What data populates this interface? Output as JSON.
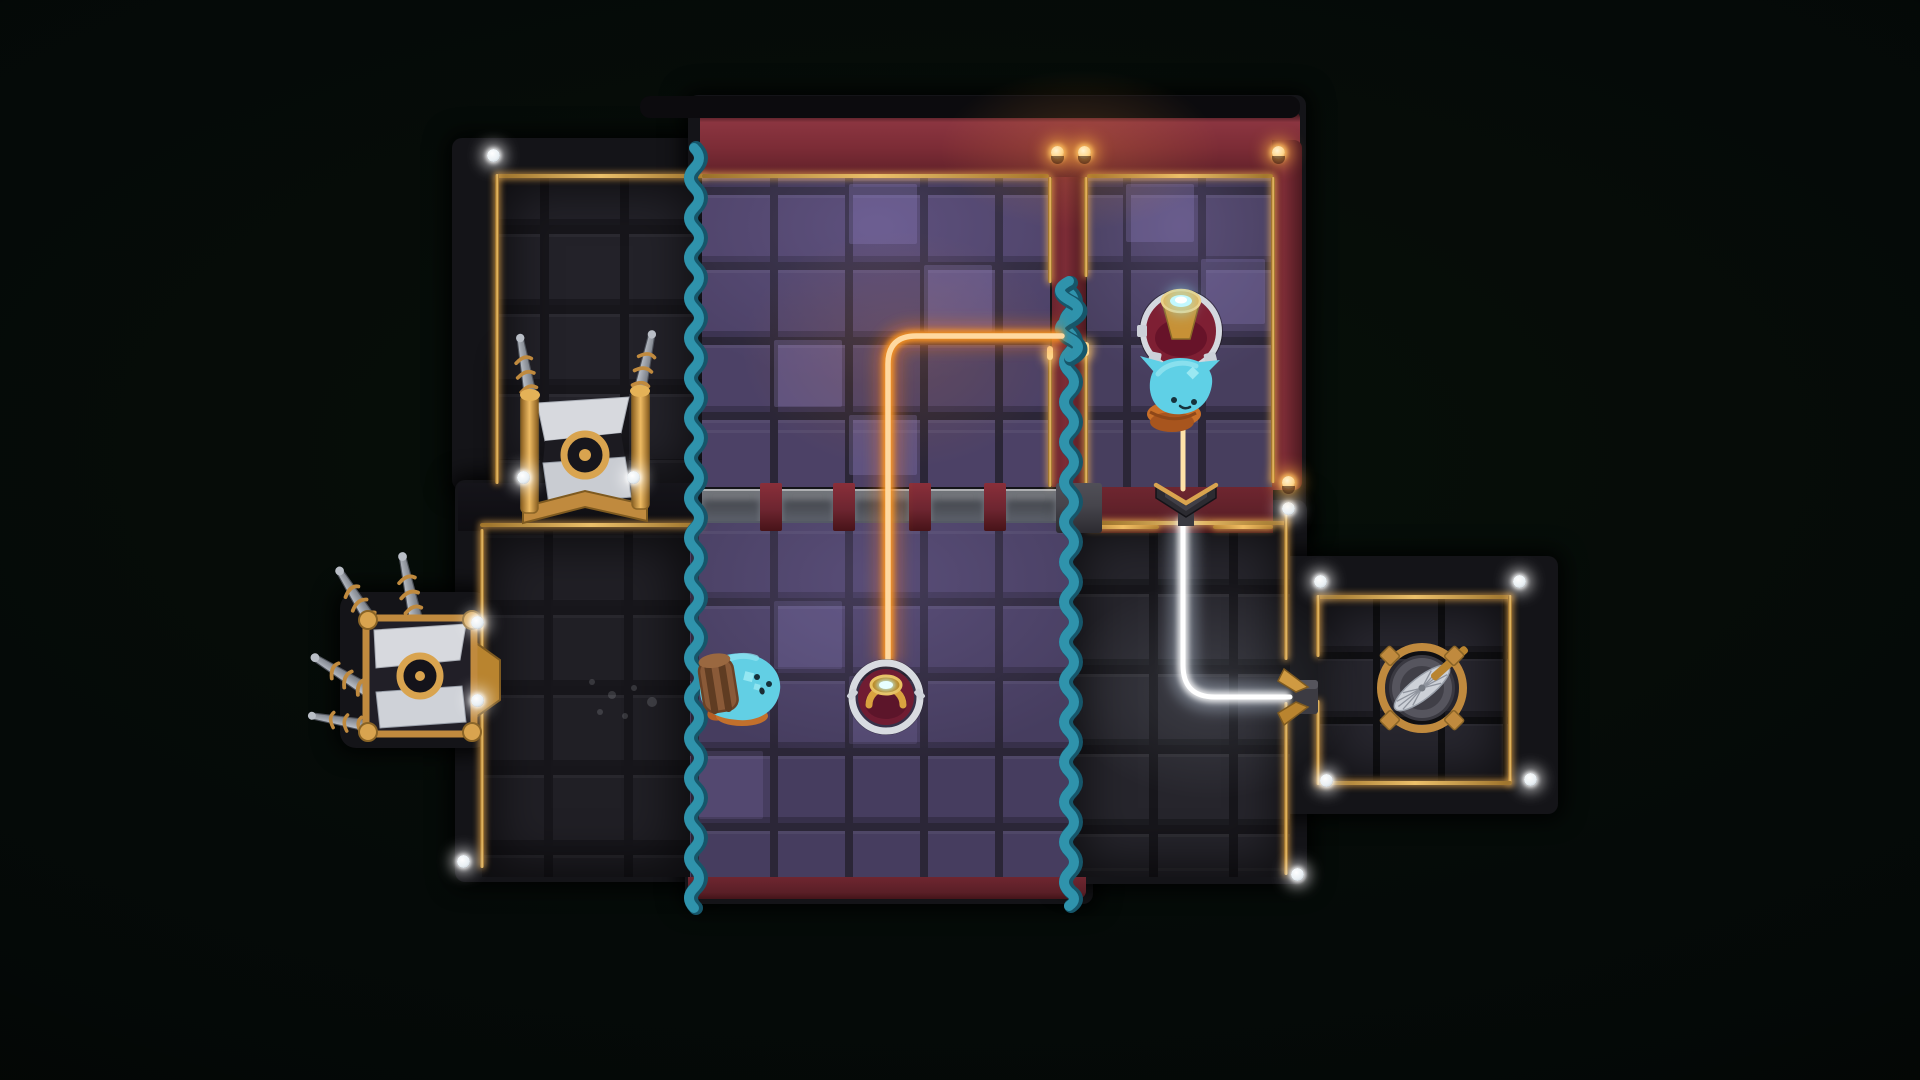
{
  "scene": {
    "kind": "top-down laser puzzle game level",
    "background": "#050a08",
    "visible_text": "none"
  },
  "palette": {
    "gold_trim": "#d9a44f",
    "red_wall": "#7c2c36",
    "maroon_wall": "#5c1f28",
    "purple_floor": "#4c4166",
    "dark_floor": "#232229",
    "teal_rope": "#2f93ac",
    "orange_beam": "#ff9b2f",
    "yellow_beam": "#ffc34f",
    "white_beam": "#ffffff",
    "cyan_gem": "#b5f4ff",
    "glass_fence": "#cfd6e2",
    "creature_blue": "#5fd0e6",
    "backpack_brown": "#8a5a38",
    "pot_orange": "#c96f28"
  },
  "rooms": [
    {
      "id": "upper-left",
      "floor": "dark tiles",
      "border": "gold trim"
    },
    {
      "id": "upper-middle",
      "floor": "purple tiles",
      "border": "red wall with gold trim"
    },
    {
      "id": "upper-right",
      "floor": "purple tiles",
      "border": "red wall with gold trim"
    },
    {
      "id": "lower-left",
      "floor": "dark tiles",
      "border": "gold trim"
    },
    {
      "id": "lower-middle",
      "floor": "purple tiles",
      "border": "red strip at bottom"
    },
    {
      "id": "lower-right",
      "floor": "dark tiles",
      "border": "gold trim"
    },
    {
      "id": "bottom-right",
      "floor": "dark tiles",
      "border": "gold trim on all sides"
    }
  ],
  "entities": {
    "emitter": {
      "label": "beam emitter turret",
      "state": "firing beam downward",
      "gem": "cyan"
    },
    "creature_pot": {
      "label": "blue creature on clay pot",
      "state": "sitting in beam below emitter"
    },
    "creature_backpack": {
      "label": "blue creature with leather backpack",
      "state": "beside left kelp rope"
    },
    "receiver": {
      "label": "beam receiver socket",
      "state": "receiving orange beam",
      "gem": "cyan"
    },
    "chevron": {
      "label": "chevron beam gate",
      "state": "beam passes through and turns white"
    },
    "wall_socket": {
      "label": "wall beam socket",
      "state": "receiving white beam"
    },
    "fan": {
      "label": "caged fan hatch",
      "state": "closed"
    },
    "rig_top": {
      "label": "chained drill rig",
      "drills": 3
    },
    "rig_left": {
      "label": "chained drill rig on left wall",
      "drills": 4
    },
    "rope_left": {
      "label": "kelp rope curtain"
    },
    "rope_right": {
      "label": "kelp rope curtain"
    },
    "twist": {
      "label": "kelp twist through wall gap"
    },
    "fence": {
      "label": "glass fence row",
      "panels": 5,
      "posts": 4
    },
    "junction": {
      "label": "stone junction block"
    }
  },
  "beams": [
    {
      "color": "#ff9b2f",
      "route": "from kelp twist in divider wall, left then down through glass fence into receiver socket"
    },
    {
      "color": "#ffc34f",
      "route": "from emitter turret down through creature to chevron gate"
    },
    {
      "color": "#ffffff",
      "route": "from chevron gate down, bending right into wall socket of bottom-right room"
    }
  ],
  "lights": {
    "white_dots": 12,
    "gold_lamps": 4
  }
}
